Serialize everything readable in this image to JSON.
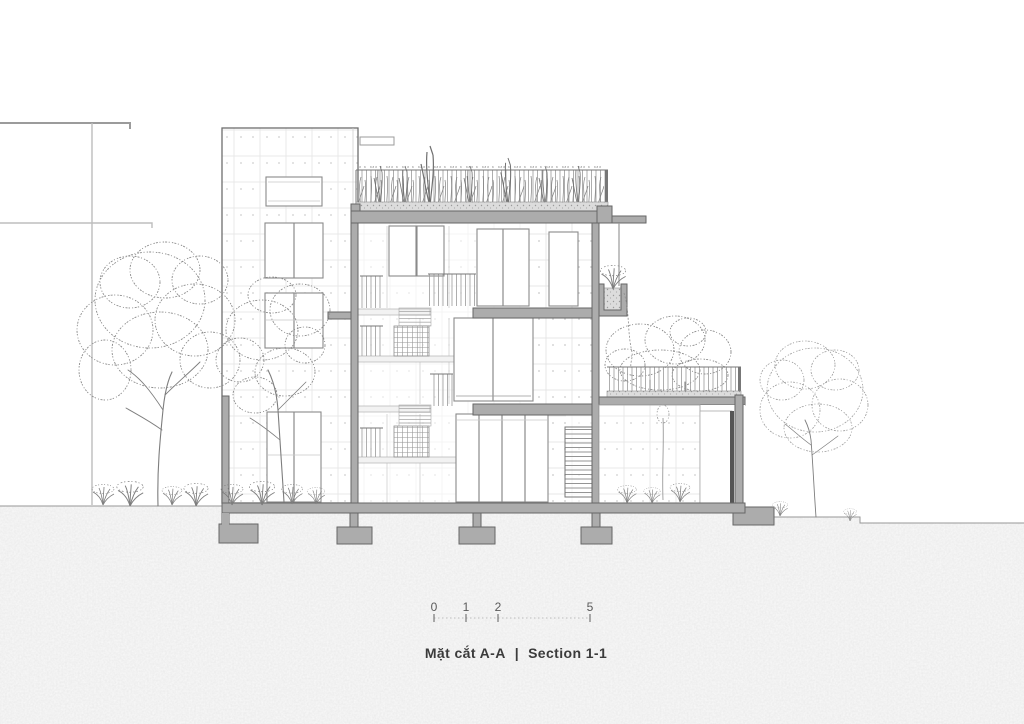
{
  "title": {
    "vi": "Mặt cắt A-A",
    "divider": "|",
    "en": "Section 1-1"
  },
  "scale_bar": {
    "labels": [
      "0",
      "1",
      "2",
      "5"
    ]
  },
  "colors": {
    "poche": "#acacac",
    "line": "#666666",
    "ground": "#e3e3e3",
    "soil": "#d8d8d8",
    "text": "#3b3b3b"
  }
}
